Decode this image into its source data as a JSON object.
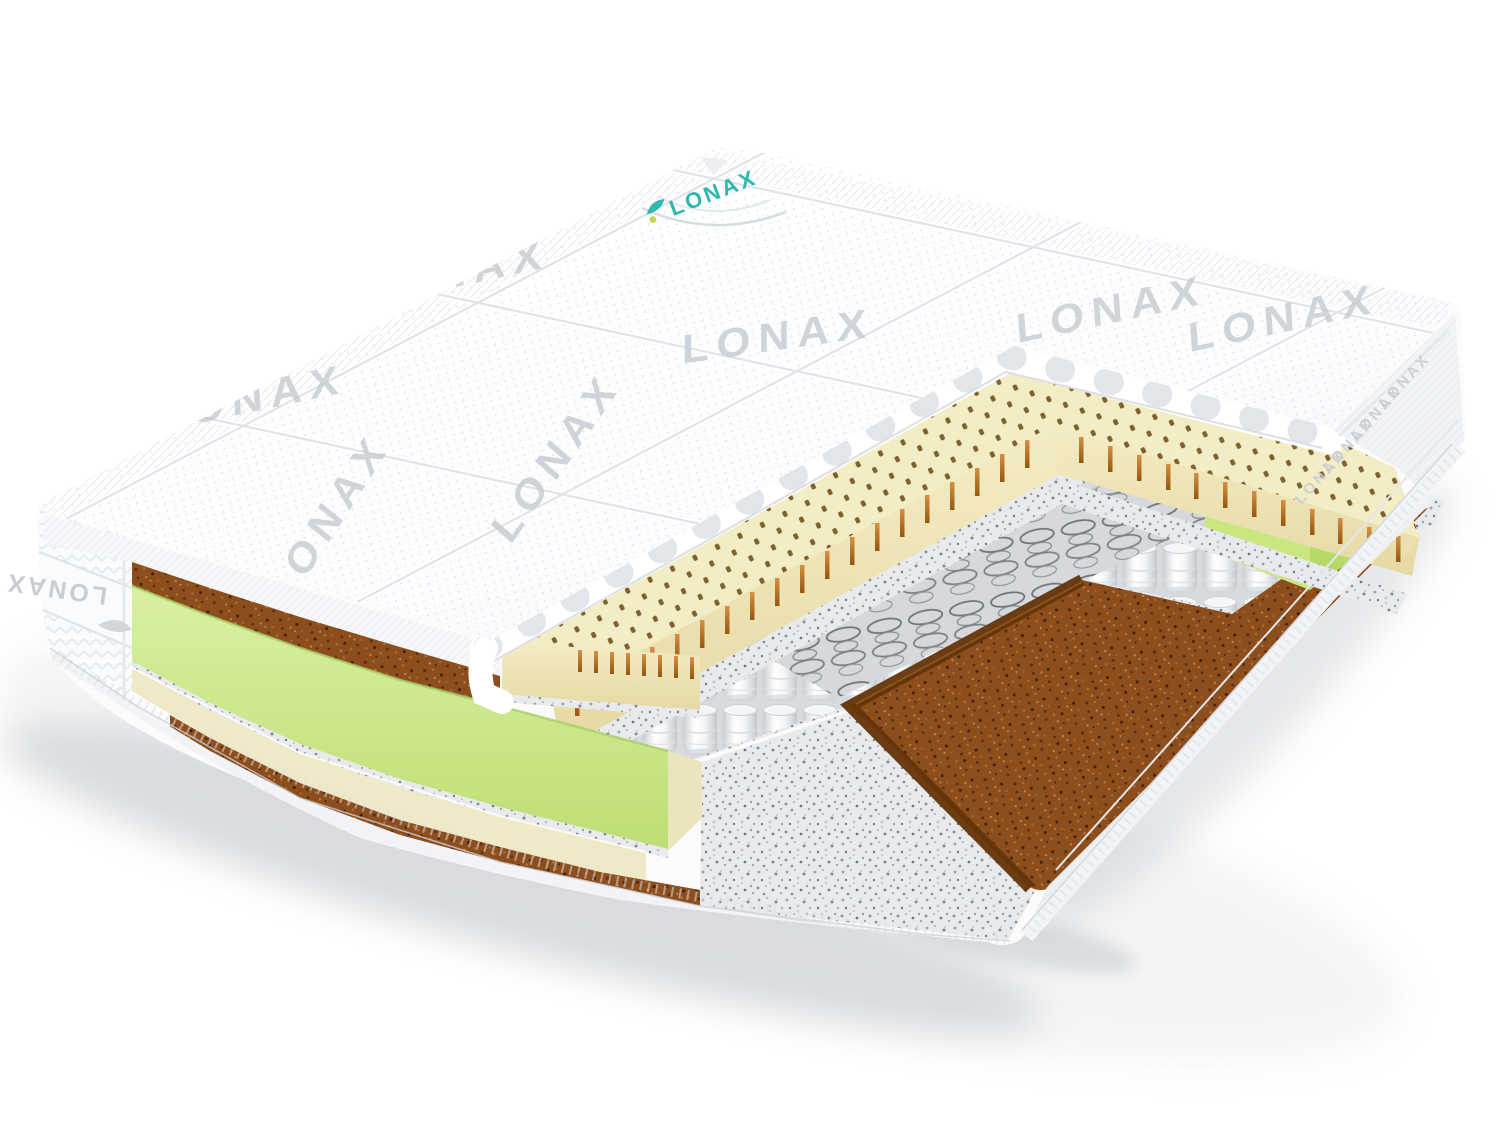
{
  "scene": {
    "type": "product-photo",
    "subject": "mattress-cutaway-3d-render",
    "background_color": "#ffffff",
    "shadow_color": "#b0b6bc"
  },
  "brand": {
    "name": "LONAX",
    "corner_label_text": "LONAX",
    "corner_label_color": "#2db8b1",
    "corner_label_accent": "#c6d84b",
    "watermark_text": "LONAX",
    "watermark_color": "#c4c9d0",
    "side_label_text": "LONAX",
    "side_label_color": "#c9cdd3"
  },
  "layers": [
    {
      "name": "quilted-knit-cover",
      "color": "#fdfdfe"
    },
    {
      "name": "coir-top-strip",
      "color": "#8d4e1e"
    },
    {
      "name": "perforated-latex-layer",
      "color": "#f3edc6"
    },
    {
      "name": "latex-perforation-pins",
      "color": "#bd7428"
    },
    {
      "name": "felt-insulator",
      "color": "#e9eaec"
    },
    {
      "name": "pocket-spring-block",
      "color": "#fafbfc"
    },
    {
      "name": "bare-spring-coils",
      "color": "#70747a"
    },
    {
      "name": "foam-edge-support",
      "color": "#cde88d"
    },
    {
      "name": "base-foam-layer",
      "color": "#efe9c8"
    },
    {
      "name": "coir-base-layer",
      "color": "#8d4e1e"
    },
    {
      "name": "binding-tape",
      "color": "#f2f3f5"
    }
  ]
}
